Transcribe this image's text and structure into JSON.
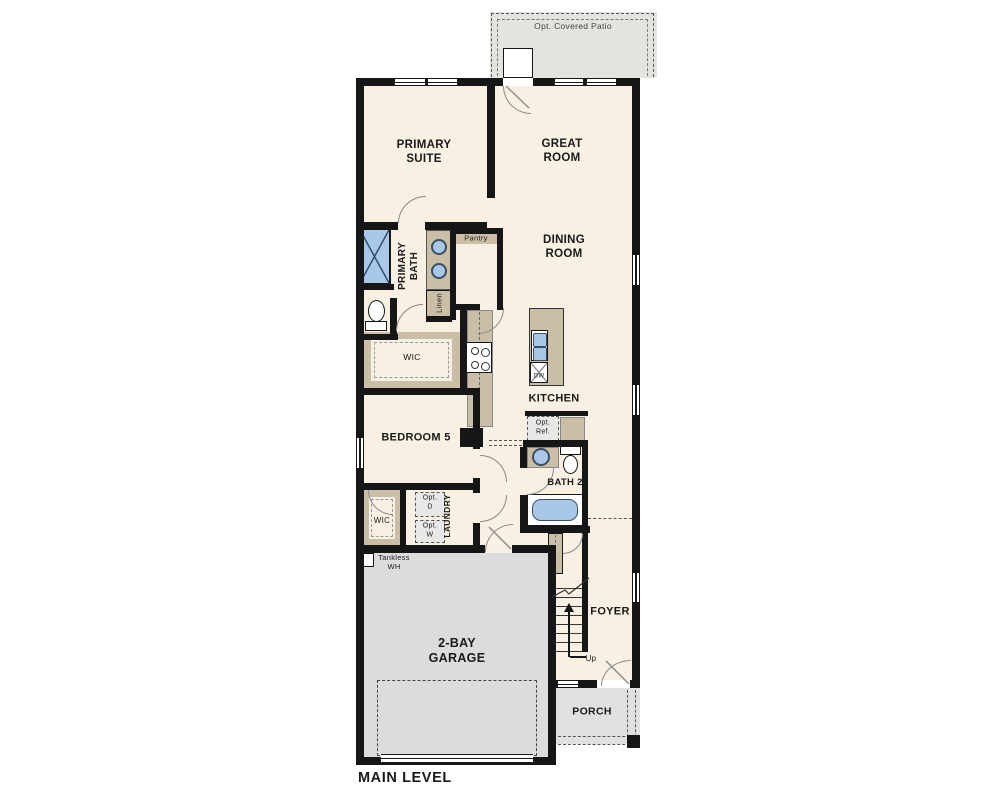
{
  "title": "MAIN LEVEL",
  "colors": {
    "floor": "#f8f0e2",
    "wall": "#161616",
    "patio": "#e4e3e0",
    "garage": "#dcdcdc",
    "porch": "#e0e0de",
    "cabinet": "#cabfa6",
    "fixture": "#a9c8e9",
    "dashfill": "#e8e8e6"
  },
  "labels": {
    "patio": "Opt. Covered Patio",
    "primary_suite": "PRIMARY\nSUITE",
    "great_room": "GREAT\nROOM",
    "dining_room": "DINING\nROOM",
    "primary_bath": "PRIMARY\nBATH",
    "pantry": "Pantry",
    "linen": "Linen",
    "wic_primary": "WIC",
    "kitchen": "KITCHEN",
    "bedroom5": "BEDROOM 5",
    "opt_ref": "Opt.\nRef.",
    "bath2": "BATH 2",
    "wic_secondary": "WIC",
    "laundry": "LAUNDRY",
    "opt_dryer": "Opt.\nD",
    "opt_washer": "Opt.\nW",
    "tankless": "Tankless\nWH",
    "garage": "2-BAY\nGARAGE",
    "foyer": "FOYER",
    "up": "Up",
    "porch": "PORCH",
    "dishwasher": "DW",
    "main_level": "MAIN LEVEL"
  }
}
